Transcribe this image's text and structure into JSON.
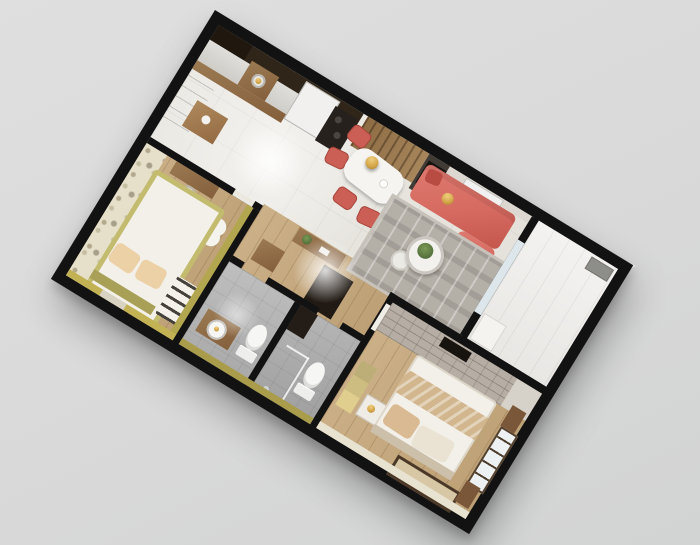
{
  "scene": {
    "type": "3d-apartment-floor-plan-render",
    "view": "top-down dollhouse cutaway",
    "rotation_deg": 31.4,
    "wall_style": "thick black cutaway walls",
    "background_style": "plain light gray studio backdrop",
    "text_content": "none"
  },
  "colors": {
    "wall": "#121212",
    "background": "#d9d9d9",
    "tile_floor": "#eae8e3",
    "wood_floor": "#ccb088",
    "cabinet_wood": "#9b7a52",
    "backsplash": "#2f2519",
    "fridge_white": "#f1f0ee",
    "stove_dark": "#26211d",
    "dining_table": "#f6f4f0",
    "chair_red": "#cc5f55",
    "sofa_red": "#d66a60",
    "rug_gray": "#b4afa7",
    "plant_green": "#55703c",
    "gold": "#d2a347",
    "tv_wall_wood": "#8d6c44",
    "tv_dark": "#17130f",
    "balcony_floor": "#f2f1ef",
    "glass": "#dde6ea",
    "wallpaper": "#e6e0cb",
    "kids_bed_frame": "#c3bc6f",
    "kids_pillow": "#ecd0a6",
    "kids_rug_white": "#f5f3ee",
    "olive_wall": "#c2b254",
    "bath_floor": "#a8a8a8",
    "fixture_white": "#f4f4f2",
    "dark_cabinet": "#211a14",
    "brick_wall": "#b6aea5",
    "master_bed": "#f3f0e9",
    "master_runner": "#d2b68e",
    "master_rug": "#d8c7a5",
    "master_rug_border": "#4b3827",
    "curtain_wood": "#7b5739",
    "yellow_dresser": "#dfce8d"
  },
  "rooms": [
    {
      "id": "kitchen",
      "name": "Kitchen",
      "items": [
        "l-shaped-counter",
        "sink-with-gold-faucet",
        "cooktop",
        "refrigerator",
        "wood-cabinets",
        "island"
      ]
    },
    {
      "id": "dining",
      "name": "Dining Area",
      "items": [
        "white-dining-table",
        "gold-pendant-lamp",
        "red-chairs-x4",
        "wood-slat-tv-wall",
        "tv-panel"
      ]
    },
    {
      "id": "living",
      "name": "Living Room",
      "items": [
        "coral-sectional-sofa",
        "gold-cushion",
        "striped-gray-rug",
        "round-coffee-table",
        "potted-plant",
        "black-side-table",
        "ac-unit",
        "console-table"
      ]
    },
    {
      "id": "balcony",
      "name": "Balcony",
      "items": [
        "sliding-glass-door",
        "ac-condenser",
        "storage-shelf"
      ]
    },
    {
      "id": "bedroom-kids",
      "name": "Kids Bedroom",
      "items": [
        "floral-wallpaper-wall",
        "olive-frame-bed",
        "peach-pillows-x2",
        "flower-shaped-rug",
        "teddy-bear",
        "striped-rug",
        "desk",
        "chair"
      ]
    },
    {
      "id": "hallway",
      "name": "Hallway",
      "items": [
        "dark-wardrobe",
        "wood-shoe-cabinet"
      ]
    },
    {
      "id": "bathroom-1",
      "name": "Bathroom 1",
      "items": [
        "wood-vanity",
        "round-sink",
        "toilet"
      ]
    },
    {
      "id": "bathroom-2",
      "name": "Bathroom 2",
      "items": [
        "toilet",
        "glass-shower"
      ]
    },
    {
      "id": "bedroom-master",
      "name": "Master Bedroom",
      "items": [
        "brick-accent-wall",
        "wall-tv",
        "double-bed",
        "beige-runner",
        "pillows-x2",
        "bordered-rug",
        "nightstand",
        "yellow-dresser",
        "window-with-wood-curtains"
      ]
    }
  ]
}
